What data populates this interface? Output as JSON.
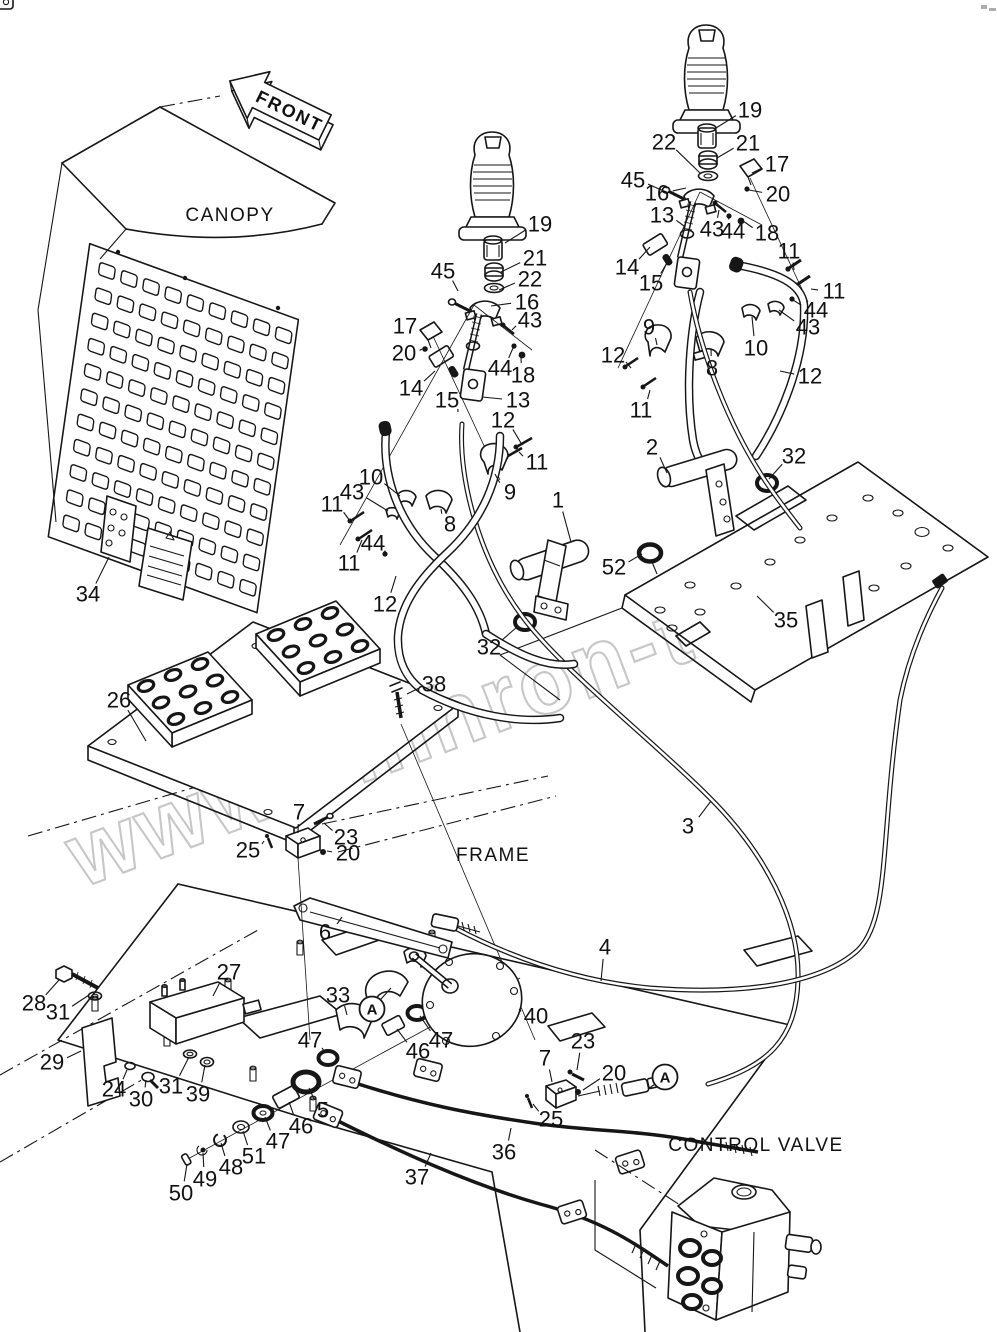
{
  "figure": {
    "front_label": "FRONT",
    "canopy_label": "CANOPY",
    "frame_label": "FRAME",
    "control_valve_label": "CONTROL VALVE"
  },
  "watermark": {
    "text": "www.sinhron-too.kz",
    "color": "#c7c7c7"
  },
  "colors": {
    "line": "#161616",
    "background": "#ffffff",
    "watermark": "#c7c7c7"
  },
  "circled_letters": [
    {
      "label": "A",
      "x": 372,
      "y": 1009,
      "tx": 391,
      "ty": 988
    },
    {
      "label": "A",
      "x": 665,
      "y": 1077,
      "tx": 648,
      "ty": 1089
    }
  ],
  "callouts": [
    [
      "19",
      750,
      110,
      716,
      128
    ],
    [
      "22",
      664,
      142,
      700,
      173
    ],
    [
      "21",
      748,
      143,
      717,
      158
    ],
    [
      "45",
      633,
      180,
      666,
      192
    ],
    [
      "17",
      777,
      164,
      752,
      173
    ],
    [
      "16",
      657,
      193,
      686,
      188
    ],
    [
      "20",
      778,
      194,
      749,
      190
    ],
    [
      "13",
      662,
      215,
      684,
      226
    ],
    [
      "43",
      712,
      229,
      719,
      210
    ],
    [
      "44",
      733,
      231,
      729,
      217
    ],
    [
      "18",
      767,
      233,
      743,
      221
    ],
    [
      "14",
      627,
      267,
      650,
      247
    ],
    [
      "15",
      651,
      283,
      668,
      261
    ],
    [
      "11",
      789,
      251,
      794,
      270
    ],
    [
      "11",
      834,
      291,
      811,
      289
    ],
    [
      "44",
      816,
      310,
      793,
      300
    ],
    [
      "43",
      808,
      327,
      779,
      310
    ],
    [
      "9",
      649,
      327,
      657,
      345
    ],
    [
      "12",
      613,
      355,
      631,
      368
    ],
    [
      "10",
      756,
      348,
      752,
      317
    ],
    [
      "8",
      712,
      368,
      711,
      349
    ],
    [
      "12",
      810,
      376,
      780,
      371
    ],
    [
      "11",
      641,
      410,
      650,
      390
    ],
    [
      "2",
      652,
      447,
      667,
      473
    ],
    [
      "32",
      794,
      456,
      769,
      479
    ],
    [
      "52",
      614,
      567,
      642,
      554
    ],
    [
      "35",
      786,
      620,
      757,
      596
    ],
    [
      "19",
      540,
      224,
      505,
      243
    ],
    [
      "21",
      535,
      258,
      501,
      272
    ],
    [
      "22",
      530,
      279,
      499,
      290
    ],
    [
      "45",
      443,
      271,
      458,
      291
    ],
    [
      "16",
      527,
      302,
      491,
      306
    ],
    [
      "17",
      405,
      326,
      422,
      332
    ],
    [
      "43",
      530,
      320,
      512,
      330
    ],
    [
      "20",
      404,
      353,
      422,
      349
    ],
    [
      "44",
      500,
      368,
      513,
      348
    ],
    [
      "18",
      523,
      375,
      521,
      357
    ],
    [
      "14",
      411,
      388,
      435,
      371
    ],
    [
      "15",
      447,
      400,
      458,
      412
    ],
    [
      "13",
      518,
      400,
      482,
      397
    ],
    [
      "12",
      503,
      420,
      521,
      443
    ],
    [
      "11",
      537,
      462,
      519,
      452
    ],
    [
      "9",
      510,
      492,
      495,
      474
    ],
    [
      "10",
      371,
      477,
      400,
      496
    ],
    [
      "43",
      352,
      492,
      388,
      511
    ],
    [
      "11",
      332,
      504,
      350,
      521
    ],
    [
      "44",
      373,
      543,
      384,
      552
    ],
    [
      "11",
      349,
      563,
      362,
      540
    ],
    [
      "8",
      450,
      524,
      441,
      509
    ],
    [
      "1",
      558,
      500,
      571,
      542
    ],
    [
      "12",
      385,
      604,
      396,
      576
    ],
    [
      "32",
      489,
      647,
      517,
      627
    ],
    [
      "26",
      119,
      700,
      146,
      741
    ],
    [
      "38",
      434,
      684,
      407,
      694
    ],
    [
      "34",
      88,
      594,
      109,
      557
    ],
    [
      "7",
      299,
      812,
      298,
      833
    ],
    [
      "23",
      346,
      837,
      324,
      823
    ],
    [
      "25",
      248,
      850,
      264,
      841
    ],
    [
      "20",
      348,
      853,
      327,
      851
    ],
    [
      "6",
      325,
      932,
      342,
      917
    ],
    [
      "3",
      688,
      826,
      711,
      801
    ],
    [
      "4",
      605,
      947,
      601,
      981
    ],
    [
      "28",
      34,
      1003,
      59,
      980
    ],
    [
      "31",
      58,
      1012,
      89,
      995
    ],
    [
      "27",
      229,
      972,
      213,
      996
    ],
    [
      "29",
      52,
      1062,
      81,
      1051
    ],
    [
      "24",
      114,
      1089,
      127,
      1070
    ],
    [
      "30",
      141,
      1099,
      146,
      1080
    ],
    [
      "31",
      171,
      1086,
      189,
      1057
    ],
    [
      "39",
      198,
      1094,
      205,
      1065
    ],
    [
      "33",
      338,
      995,
      347,
      1015
    ],
    [
      "47",
      310,
      1040,
      325,
      1053
    ],
    [
      "5",
      323,
      1110,
      309,
      1088
    ],
    [
      "46",
      301,
      1126,
      289,
      1102
    ],
    [
      "47",
      278,
      1141,
      265,
      1117
    ],
    [
      "51",
      254,
      1156,
      243,
      1131
    ],
    [
      "48",
      231,
      1167,
      221,
      1143
    ],
    [
      "49",
      205,
      1179,
      203,
      1153
    ],
    [
      "50",
      181,
      1193,
      187,
      1164
    ],
    [
      "40",
      536,
      1016,
      519,
      1009
    ],
    [
      "47",
      441,
      1040,
      420,
      1016
    ],
    [
      "46",
      418,
      1051,
      397,
      1029
    ],
    [
      "23",
      583,
      1041,
      577,
      1070
    ],
    [
      "7",
      545,
      1058,
      552,
      1082
    ],
    [
      "20",
      614,
      1073,
      583,
      1090
    ],
    [
      "25",
      551,
      1119,
      533,
      1104
    ],
    [
      "36",
      504,
      1152,
      511,
      1128
    ],
    [
      "37",
      417,
      1177,
      431,
      1153
    ]
  ]
}
